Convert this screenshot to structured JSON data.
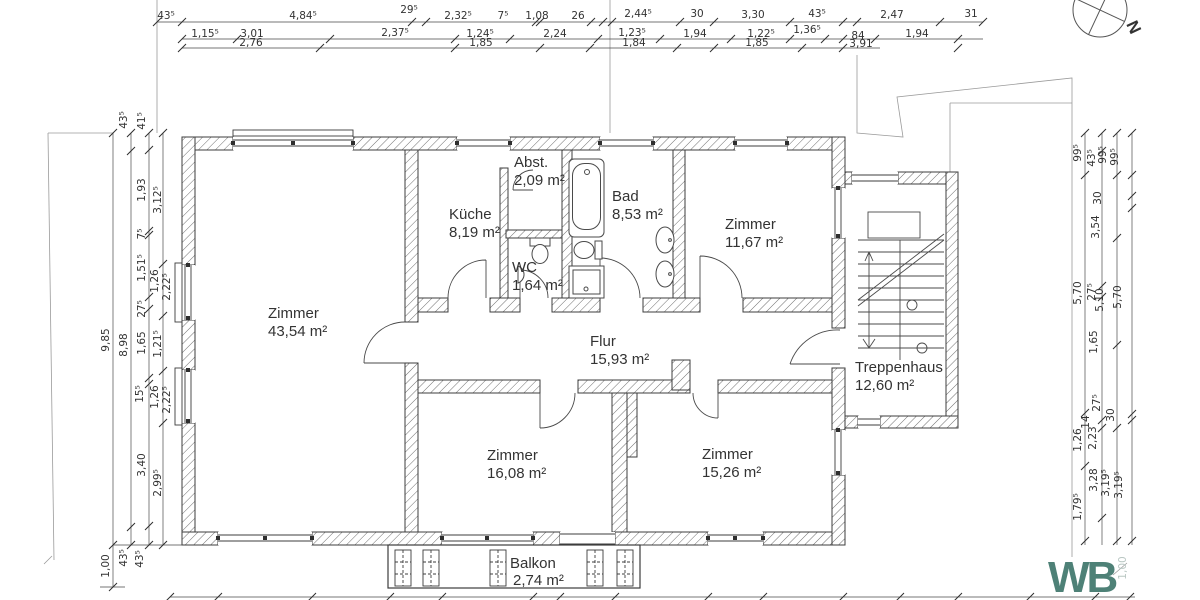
{
  "drawing": {
    "type": "Grundriss Obergeschoss Wohnungsplan"
  },
  "north": {
    "label": "N"
  },
  "logo": {
    "text": "WB",
    "color": "#4e8177"
  },
  "rooms": {
    "zimmer1": {
      "name": "Zimmer",
      "area": "43,54 m²"
    },
    "kueche": {
      "name": "Küche",
      "area": "8,19 m²"
    },
    "abst": {
      "name": "Abst.",
      "area": "2,09 m²"
    },
    "bad": {
      "name": "Bad",
      "area": "8,53 m²"
    },
    "wc": {
      "name": "WC",
      "area": "1,64 m²"
    },
    "zimmer2": {
      "name": "Zimmer",
      "area": "11,67 m²"
    },
    "flur": {
      "name": "Flur",
      "area": "15,93 m²"
    },
    "zimmer3": {
      "name": "Zimmer",
      "area": "16,08 m²"
    },
    "zimmer4": {
      "name": "Zimmer",
      "area": "15,26 m²"
    },
    "treppenhaus": {
      "name": "Treppenhaus",
      "area": "12,60 m²"
    },
    "balkon": {
      "name": "Balkon",
      "area": "2,74 m²"
    }
  },
  "dims": {
    "top1": [
      "43⁵",
      "4,84⁵",
      "29⁵",
      "2,32⁵",
      "7⁵",
      "1,08",
      "26",
      "2,44⁵",
      "30",
      "3,30",
      "43⁵",
      "2,47",
      "31"
    ],
    "top2": [
      "1,15⁵",
      "3,01",
      "2,37⁵",
      "1,24⁵",
      "2,24",
      "1,23⁵",
      "1,94",
      "1,22⁵",
      "1,36⁵",
      "84",
      "1,94"
    ],
    "top3": [
      "2,76",
      "1,85",
      "1,84",
      "1,85",
      "3,91"
    ],
    "left": [
      "9,85",
      "43⁵",
      "8,98",
      "43⁵",
      "41⁵",
      "1,93",
      "7⁵",
      "1,51⁵",
      "27⁵",
      "1,65",
      "15⁵",
      "3,40",
      "43⁵",
      "3,12⁵",
      "1,26",
      "2,22⁵",
      "1,21⁵",
      "1,26",
      "2,22⁵",
      "2,99⁵",
      "1,00"
    ],
    "right": [
      "99⁵",
      "5,70",
      "1,26",
      "1,79⁵",
      "43⁵",
      "27⁵",
      "14",
      "2,23",
      "3,28",
      "99⁵",
      "30",
      "3,54",
      "5,10",
      "27⁵",
      "3,19⁵",
      "99⁵",
      "5,70",
      "30",
      "3,19⁵",
      "1,65",
      "1,00"
    ]
  }
}
